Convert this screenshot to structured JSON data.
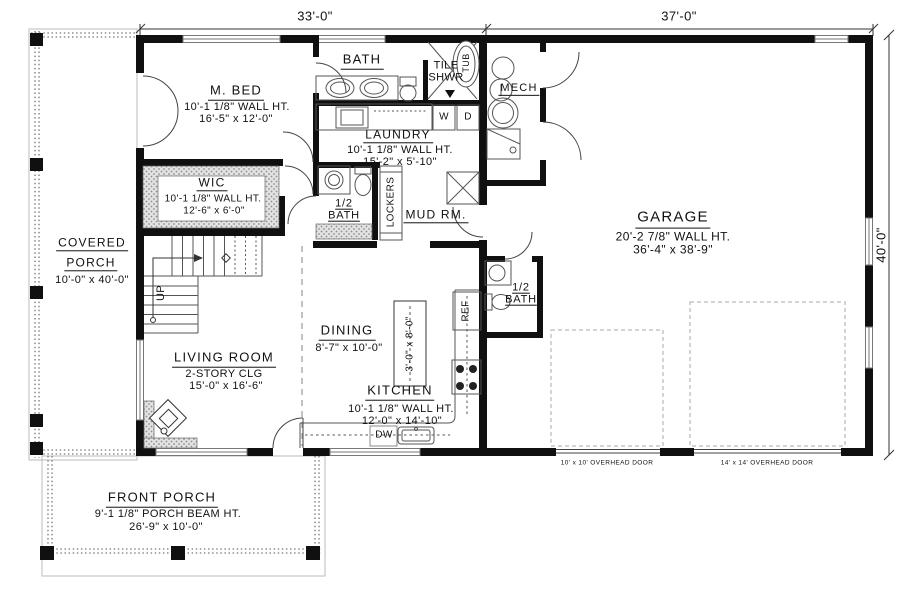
{
  "dimensions": {
    "top_left": "33'-0\"",
    "top_right": "37'-0\"",
    "right_side": "40'-0\""
  },
  "rooms": {
    "m_bed": {
      "name": "M. BED",
      "wall_ht": "10'-1 1/8\" WALL HT.",
      "size": "16'-5\" x 12'-0\""
    },
    "bath": {
      "name": "BATH"
    },
    "tile_shwr": {
      "name": "TILE SHWR"
    },
    "tub": {
      "name": "TUB"
    },
    "mech": {
      "name": "MECH"
    },
    "laundry": {
      "name": "LAUNDRY",
      "wall_ht": "10'-1 1/8\" WALL HT.",
      "size": "15'-2\" x 5'-10\""
    },
    "washer": {
      "name": "W"
    },
    "dryer": {
      "name": "D"
    },
    "wic": {
      "name": "WIC",
      "wall_ht": "10'-1 1/8\" WALL HT.",
      "size": "12'-6\" x 6'-0\""
    },
    "half_bath_upper": {
      "name": "1/2 BATH"
    },
    "lockers": {
      "name": "LOCKERS"
    },
    "mud_rm": {
      "name": "MUD RM."
    },
    "garage": {
      "name": "GARAGE",
      "wall_ht": "20'-2 7/8\" WALL HT.",
      "size": "36'-4\" x 38'-9\""
    },
    "covered_porch": {
      "name_line1": "COVERED",
      "name_line2": "PORCH",
      "size": "10'-0\" x 40'-0\""
    },
    "stairs": {
      "direction": "UP"
    },
    "living_room": {
      "name": "LIVING ROOM",
      "ceiling": "2-STORY CLG",
      "size": "15'-0\" x 16'-6\""
    },
    "dining": {
      "name": "DINING",
      "size": "8'-7\" x 10'-0\""
    },
    "kitchen_island": {
      "size": "3'-0\" x 8'-0\""
    },
    "kitchen": {
      "name": "KITCHEN",
      "wall_ht": "10'-1 1/8\" WALL HT.",
      "size": "12'-0\" x 14'-10\""
    },
    "dishwasher": {
      "name": "DW"
    },
    "refrigerator": {
      "name": "REF"
    },
    "half_bath_lower": {
      "name": "1/2 BATH"
    },
    "front_porch": {
      "name": "FRONT PORCH",
      "beam_ht": "9'-1 1/8\" PORCH BEAM HT.",
      "size": "26'-9\" x 10'-0\""
    }
  },
  "garage_doors": {
    "small": "10' x 10' OVERHEAD DOOR",
    "large": "14' x 14' OVERHEAD DOOR"
  }
}
